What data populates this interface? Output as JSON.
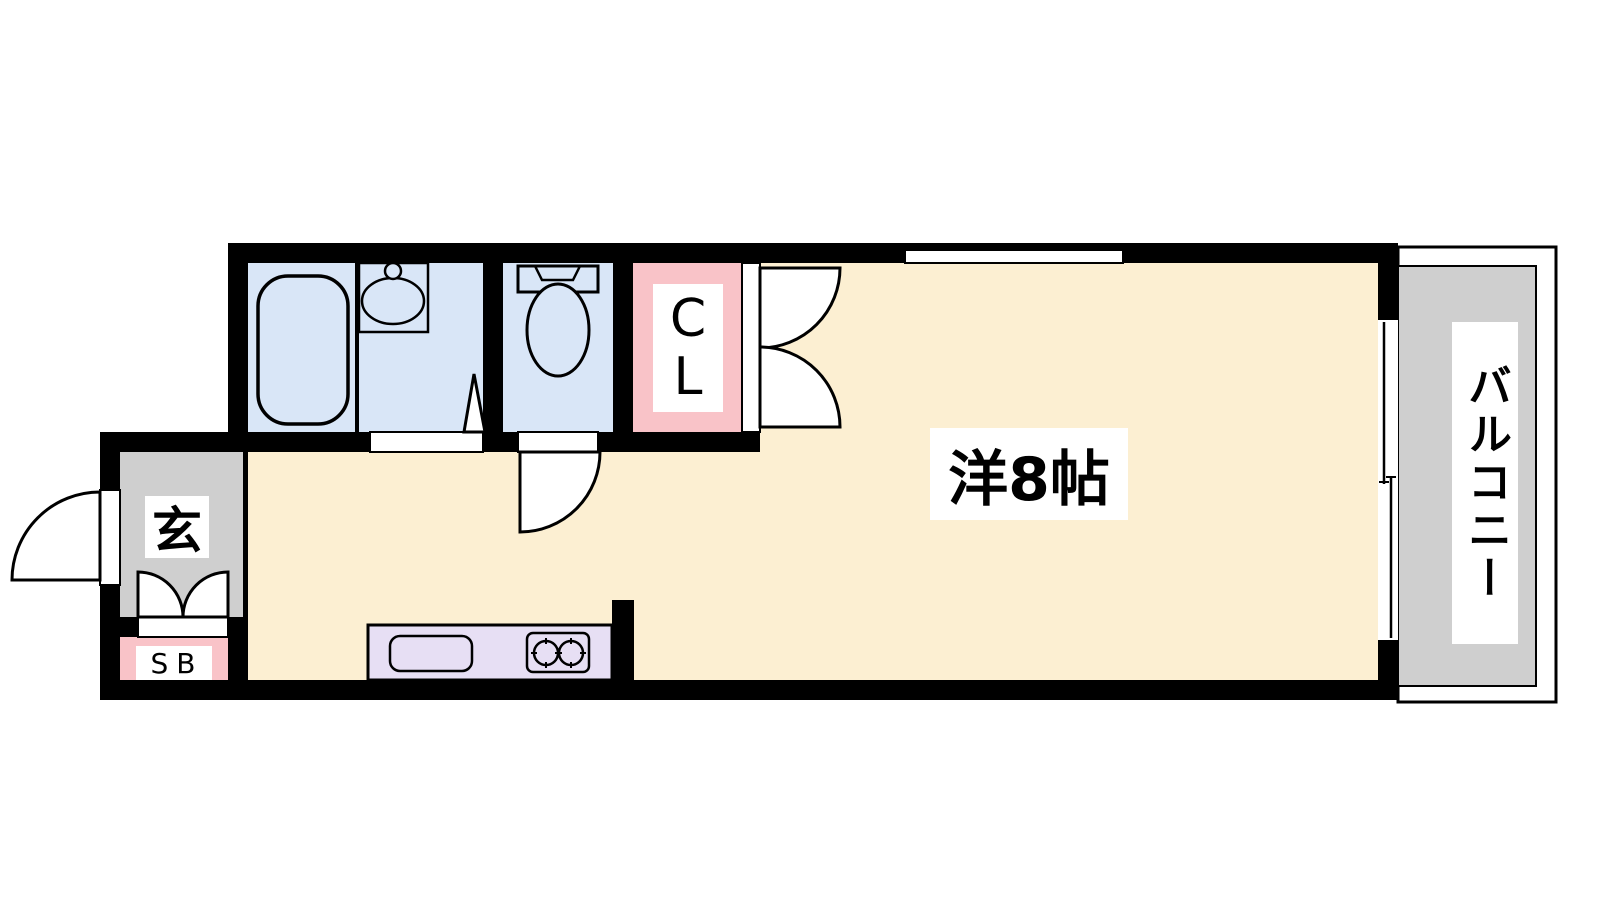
{
  "diagram": {
    "type": "floor-plan",
    "rooms": {
      "western_room": {
        "label": "洋8帖"
      },
      "balcony": {
        "label": "バルコニー"
      },
      "entrance": {
        "label": "玄"
      },
      "shoe_box": {
        "label": "SB"
      },
      "closet": {
        "label": "CL"
      }
    },
    "fixtures": [
      "bathtub",
      "washbasin",
      "toilet",
      "kitchen-sink",
      "two-burner-stove",
      "entrance-door-swing",
      "toilet-door-swing",
      "washroom-folding-door",
      "closet-double-doors",
      "shoe-box-double-doors",
      "balcony-sliding-window",
      "top-wall-window"
    ],
    "colors": {
      "wall": "#000000",
      "room_cream": "#FCEFD2",
      "wet_area_blue": "#D9E6F7",
      "accent_pink": "#F9C3C8",
      "kitchen_lavender": "#E7DFF4",
      "floor_gray": "#CFCFCF",
      "white": "#FFFFFF"
    }
  }
}
